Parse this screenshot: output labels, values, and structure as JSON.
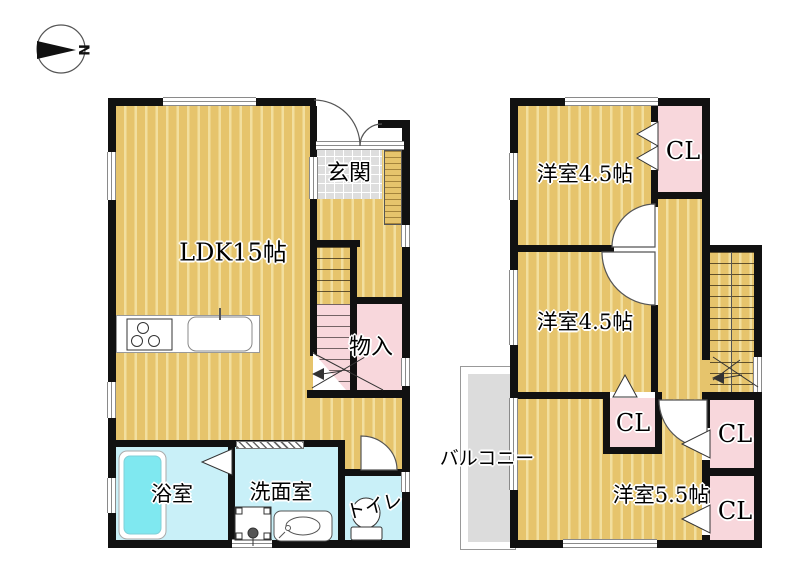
{
  "compass": {
    "north_label": "N"
  },
  "colors": {
    "wall": "#111111",
    "floor": "#E6C46C",
    "floor-stripe": "#F2DF9F",
    "pink": "#F8D7DC",
    "cyan": "#C9F0F8",
    "tub": "#7FE8F0",
    "tile": "#DEDEDE",
    "balcony": "#DCDCDC"
  },
  "floor1": {
    "rooms": {
      "ldk": "LDK15帖",
      "genkan": "玄関",
      "storage": "物入",
      "bath": "浴室",
      "washroom": "洗面室",
      "toilet": "トイレ"
    }
  },
  "floor2": {
    "rooms": {
      "bedroom_a": "洋室4.5帖",
      "bedroom_b": "洋室4.5帖",
      "bedroom_c": "洋室5.5帖",
      "balcony": "バルコニー"
    },
    "closets": [
      "CL",
      "CL",
      "CL",
      "CL"
    ]
  }
}
